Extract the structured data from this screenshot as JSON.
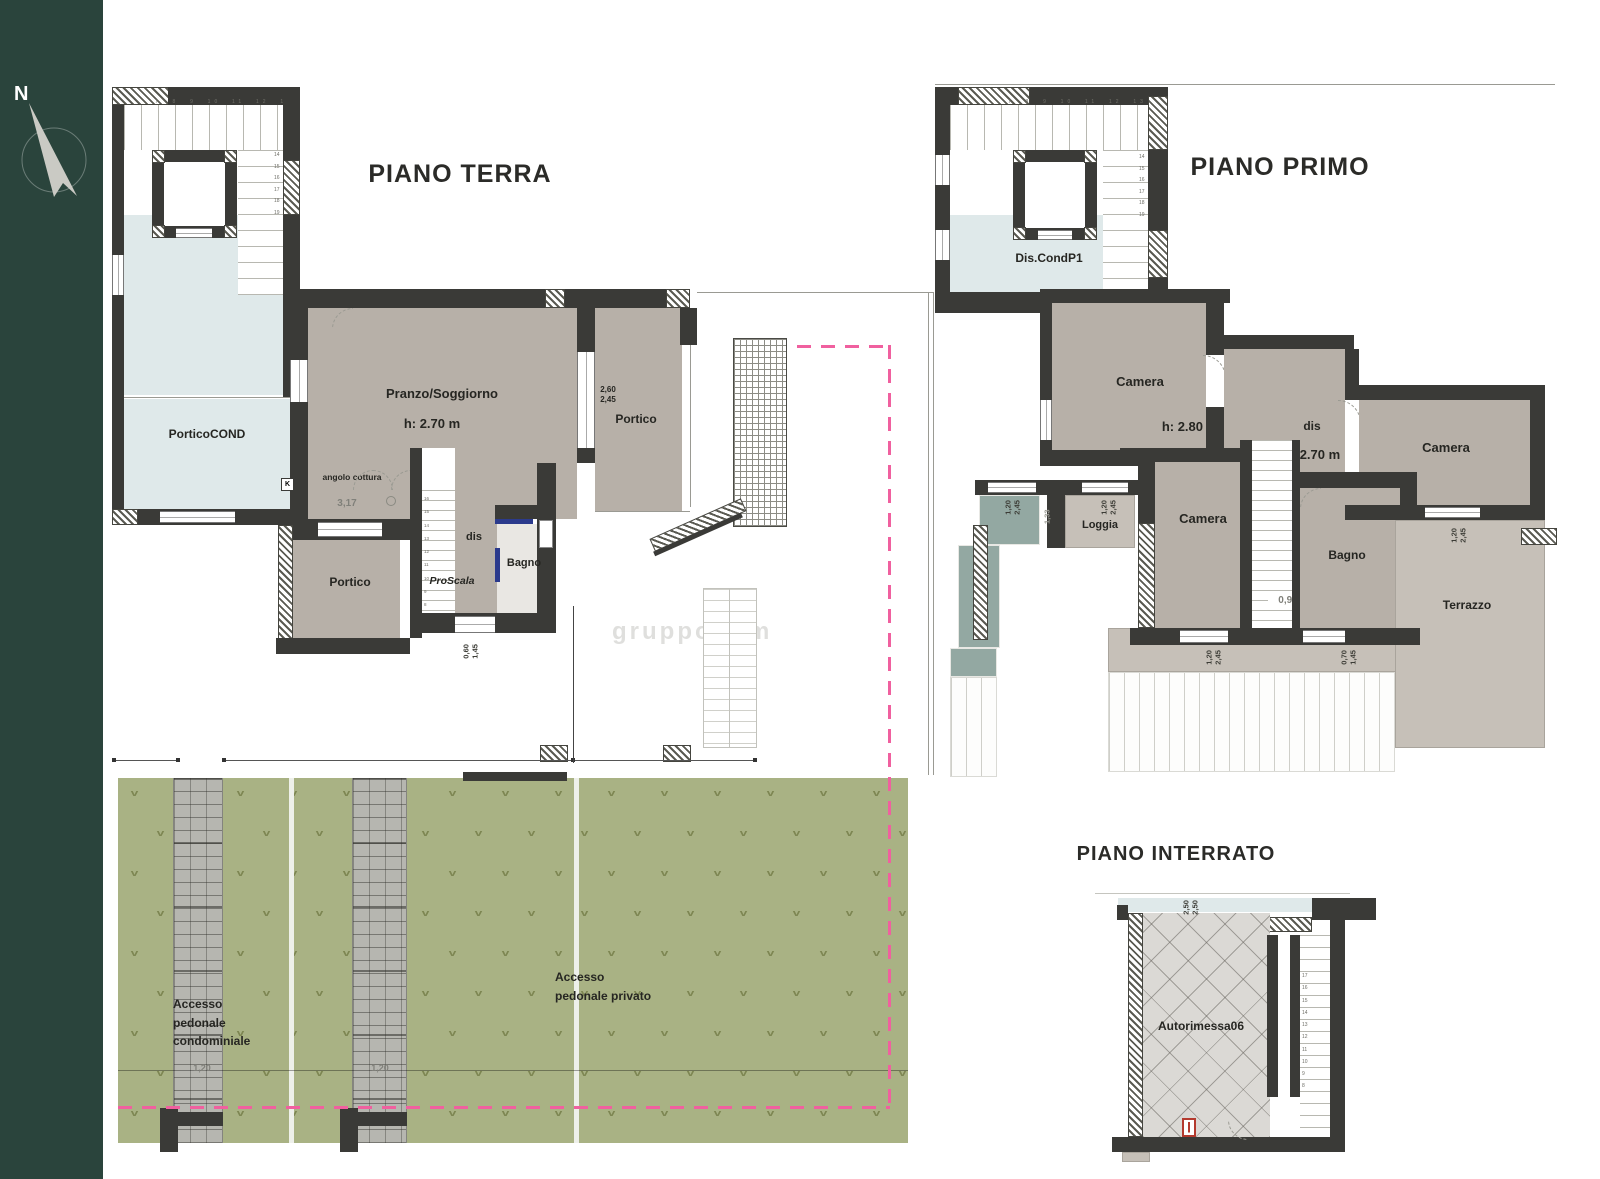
{
  "compass": {
    "north": "N"
  },
  "titles": {
    "terra": "PIANO TERRA",
    "primo": "PIANO PRIMO",
    "interrato": "PIANO INTERRATO"
  },
  "terra": {
    "portico_cond": "PorticoCOND",
    "pranzo": "Pranzo/Soggiorno",
    "pranzo_h": "h: 2.70 m",
    "angolo": "angolo cottura",
    "k": "K",
    "portico_right": "Portico",
    "portico_bottom": "Portico",
    "dis": "dis",
    "proscala": "ProScala",
    "bagno": "Bagno",
    "stair_top_nums": "7  8  9  10  11  12  13",
    "stair_side_nums": "14\n15\n16\n17\n18\n19",
    "proscala_nums": "16\n15\n14\n13\n12\n11\n10\n9\n8\n7"
  },
  "primo": {
    "dis_cond": "Dis.CondP1",
    "camera1": "Camera",
    "camera1_h": "h: 2.80 m",
    "dis": "dis",
    "dis_h": "h: 2.70 m",
    "camera2": "Camera",
    "camera3": "Camera",
    "loggia": "Loggia",
    "bagno": "Bagno",
    "terrazzo": "Terrazzo",
    "stair_top_nums": "7  8  9  10  11  12  13",
    "stair_side_nums": "14\n15\n16\n17\n18\n19"
  },
  "interrato": {
    "autorimessa": "Autorimessa06",
    "stair_nums": "17\n16\n15\n14\n13\n12\n11\n10\n9\n8"
  },
  "garden": {
    "accesso_cond": "Accesso\npedonale\ncondominiale",
    "accesso_priv": "Accesso\npedonale privato",
    "path_dim_a": "1,20",
    "path_dim_b": "1,20"
  },
  "dims": {
    "d317": "3,17",
    "d091": "0,91",
    "d133": "1,33",
    "w260_245": "2,60\n2,45",
    "w120_245": "1,20\n2,45",
    "w160_245": "1,60\n2,45",
    "w060_145": "0,60\n1,45",
    "w070_145": "0,70\n1,45",
    "w250_250": "2,50\n2,50"
  },
  "watermark": {
    "text": "gruppodom"
  },
  "colors": {
    "sidebar_green": "#2a443c",
    "wall_dark": "#3a3a37",
    "room_gray": "#b7b0a8",
    "terrace_gray": "#c6c0b8",
    "water_blue": "#dfe9ea",
    "teal": "#93a8a2",
    "garden_green": "#a9b284",
    "boundary_pink": "#f0609f",
    "accent_blue": "#2b3a8c",
    "fixture_red": "#b43a2e"
  }
}
